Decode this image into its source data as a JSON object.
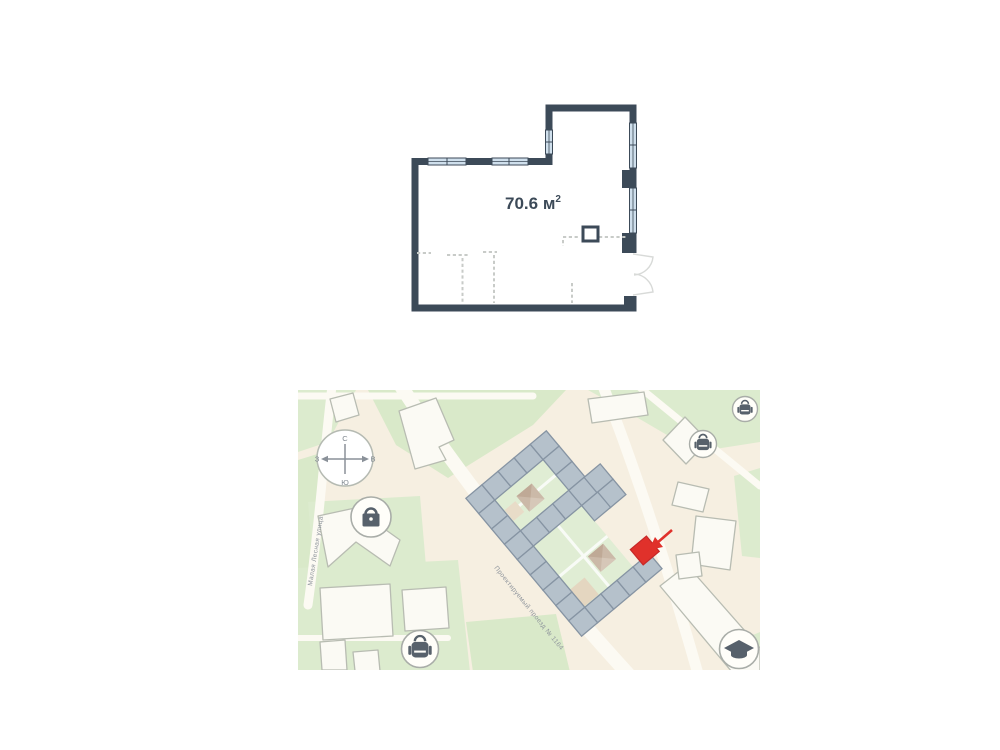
{
  "floor_plan": {
    "area_value": "70.6",
    "area_unit": "м",
    "area_superscript": "2"
  },
  "map": {
    "compass": {
      "north": "С",
      "east": "В",
      "south": "Ю",
      "west": "З"
    },
    "streets": [
      {
        "name": "Малая Лесная улица"
      },
      {
        "name": "Проектируемый проезд № 1164"
      }
    ],
    "poi": [
      {
        "icon": "lock-icon"
      },
      {
        "icon": "school-backpack-icon"
      },
      {
        "icon": "school-backpack-icon"
      },
      {
        "icon": "school-backpack-icon"
      },
      {
        "icon": "graduation-cap-icon"
      }
    ],
    "marker": {
      "label": "highlighted building section",
      "color": "#e0312b"
    }
  },
  "colors": {
    "wall": "#3c4a58",
    "window": "#cfdfec",
    "dashed": "#c8cbc8",
    "door_arc": "#d8dad8",
    "map_bg": "#f6efe1",
    "green": "#dcebce",
    "road": "#fcfaf3",
    "building": "#fbfaf4",
    "building_stroke": "#b8bcb2",
    "complex_fill": "#b5c1cb",
    "complex_stroke": "#8694a3",
    "courtyard": "#e0edd4",
    "red": "#e0312b",
    "icon_glyph": "#57616b",
    "label": "#8d939b"
  }
}
